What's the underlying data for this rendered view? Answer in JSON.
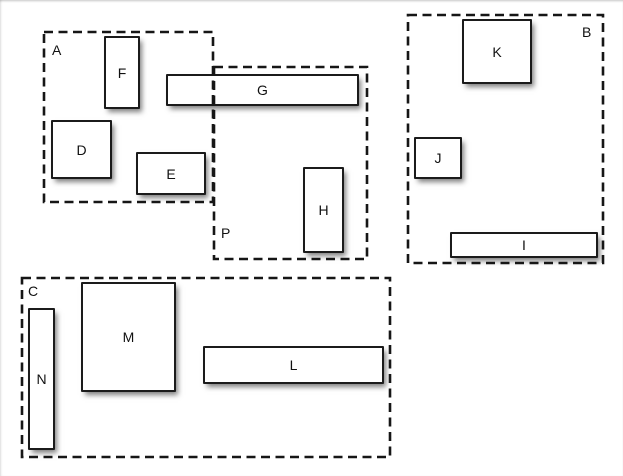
{
  "title": "Grouped rectangles diagram",
  "canvas": {
    "background": "#ffffff",
    "line_color": "#161616",
    "rect_fill": "#ffffff",
    "shadow_color": "rgba(0,0,0,0.5)"
  },
  "groups": [
    {
      "label": "A",
      "label_corner": "top-left",
      "style": "dashed",
      "contains": [
        "F",
        "D",
        "E"
      ]
    },
    {
      "label": "B",
      "label_corner": "top-right",
      "style": "dashed",
      "contains": [
        "K",
        "J",
        "I"
      ]
    },
    {
      "label": "C",
      "label_corner": "top-left",
      "style": "dashed",
      "contains": [
        "N",
        "M",
        "L"
      ]
    },
    {
      "label": "P",
      "label_corner": "bottom-left",
      "style": "dashed",
      "contains": [
        "G",
        "H"
      ]
    }
  ],
  "rects": [
    {
      "label": "D"
    },
    {
      "label": "E"
    },
    {
      "label": "F"
    },
    {
      "label": "G"
    },
    {
      "label": "H"
    },
    {
      "label": "I"
    },
    {
      "label": "J"
    },
    {
      "label": "K"
    },
    {
      "label": "L"
    },
    {
      "label": "M"
    },
    {
      "label": "N"
    }
  ]
}
